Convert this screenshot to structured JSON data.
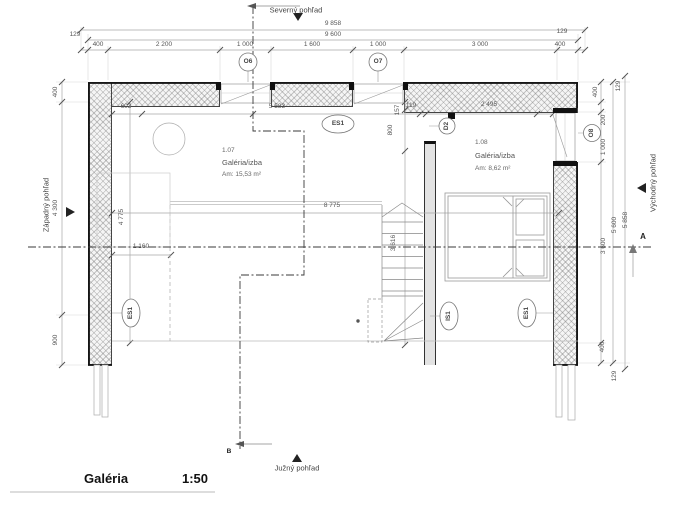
{
  "title": {
    "name": "Galéria",
    "scale": "1:50"
  },
  "views": {
    "north": "Severný pohľad",
    "south": "Južný pohľad",
    "west": "Západný pohľad",
    "east": "Východný pohľad"
  },
  "rooms": {
    "left": {
      "number": "1.07",
      "name": "Galéria/izba",
      "area": "Am: 15,53 m²"
    },
    "right": {
      "number": "1.08",
      "name": "Galéria/izba",
      "area": "Am: 8,62 m²"
    }
  },
  "marks": {
    "o6": "O6",
    "o7": "O7",
    "o8": "O8",
    "d2": "D2",
    "es1_top": "ES1",
    "es1_left": "ES1",
    "es1_right": "ES1",
    "is1": "IS1",
    "section_a": "A",
    "section_b": "B"
  },
  "dims": {
    "top": {
      "overall": "9 858",
      "inner": "9 600",
      "seg": [
        "400",
        "2 200",
        "1 000",
        "1 600",
        "1 000",
        "3 000",
        "400"
      ],
      "off_l": "129",
      "off_r": "129"
    },
    "left": {
      "seg": [
        "400",
        "4 300",
        "900"
      ]
    },
    "right": {
      "seg": [
        "400",
        "200",
        "1 000",
        "3 600",
        "400"
      ],
      "inner": "5 600",
      "overall": "5 858",
      "off_t": "129",
      "off_b": "129"
    },
    "inner": {
      "d603": "603",
      "d5583": "5 583",
      "d119": "119",
      "d2495": "2 495",
      "d8775": "8 775",
      "d4775": "4 775",
      "d1160": "1 160",
      "d157": "157",
      "d800": "800",
      "d3616": "3 616"
    }
  },
  "colors": {
    "ink": "#222222",
    "dim_line": "#999999",
    "hatch": "#f5f5f5",
    "bg": "#ffffff"
  }
}
